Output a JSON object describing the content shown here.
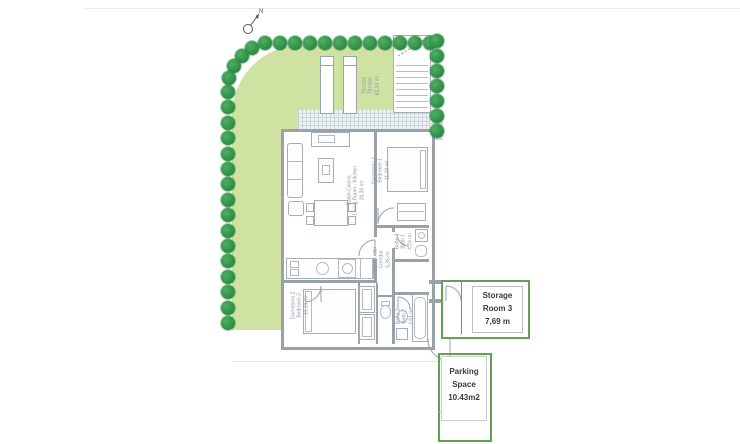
{
  "compass": {
    "label": "N"
  },
  "colors": {
    "grass": "#cfe2a2",
    "tree": "#2f9148",
    "tree_dark": "#1e7a38",
    "wall": "#9aa1a9",
    "annotation_green": "#5fa351",
    "hatch_line": "#c6d6da",
    "label_text": "#8d97a6"
  },
  "garden": {
    "terrace_label": {
      "name_es": "Terraza",
      "name_en": "Terrace",
      "area": "62,34 m²"
    },
    "trees": {
      "top": 12,
      "corner": 4,
      "left": 16,
      "right": 7
    }
  },
  "rooms": [
    {
      "id": "living",
      "name_es": "Salón-Cocina",
      "name_en": "Living Room - Kitchen",
      "area": "29,30 m²"
    },
    {
      "id": "bedroom1",
      "name_es": "Dormitorio 1",
      "name_en": "Bedroom 1",
      "area": "11,19 m²"
    },
    {
      "id": "bath1",
      "name_es": "Baño 1",
      "name_en": "Bath 1",
      "area": "4,24 m²"
    },
    {
      "id": "corridor",
      "name_es": "Distribuidor",
      "name_en": "Corridor",
      "area": "5,35 m²"
    },
    {
      "id": "bedroom2",
      "name_es": "Dormitorio 2",
      "name_en": "Bedroom 2",
      "area": "10,14 m²"
    },
    {
      "id": "bath2",
      "name_es": "Baño 2",
      "name_en": "Bath 2",
      "area": "3,91 m²"
    }
  ],
  "annotations": {
    "storage": {
      "line1": "Storage",
      "line2": "Room 3",
      "line3": "7,69 m"
    },
    "parking": {
      "line1": "Parking",
      "line2": "Space",
      "line3": "10.43m2"
    }
  }
}
